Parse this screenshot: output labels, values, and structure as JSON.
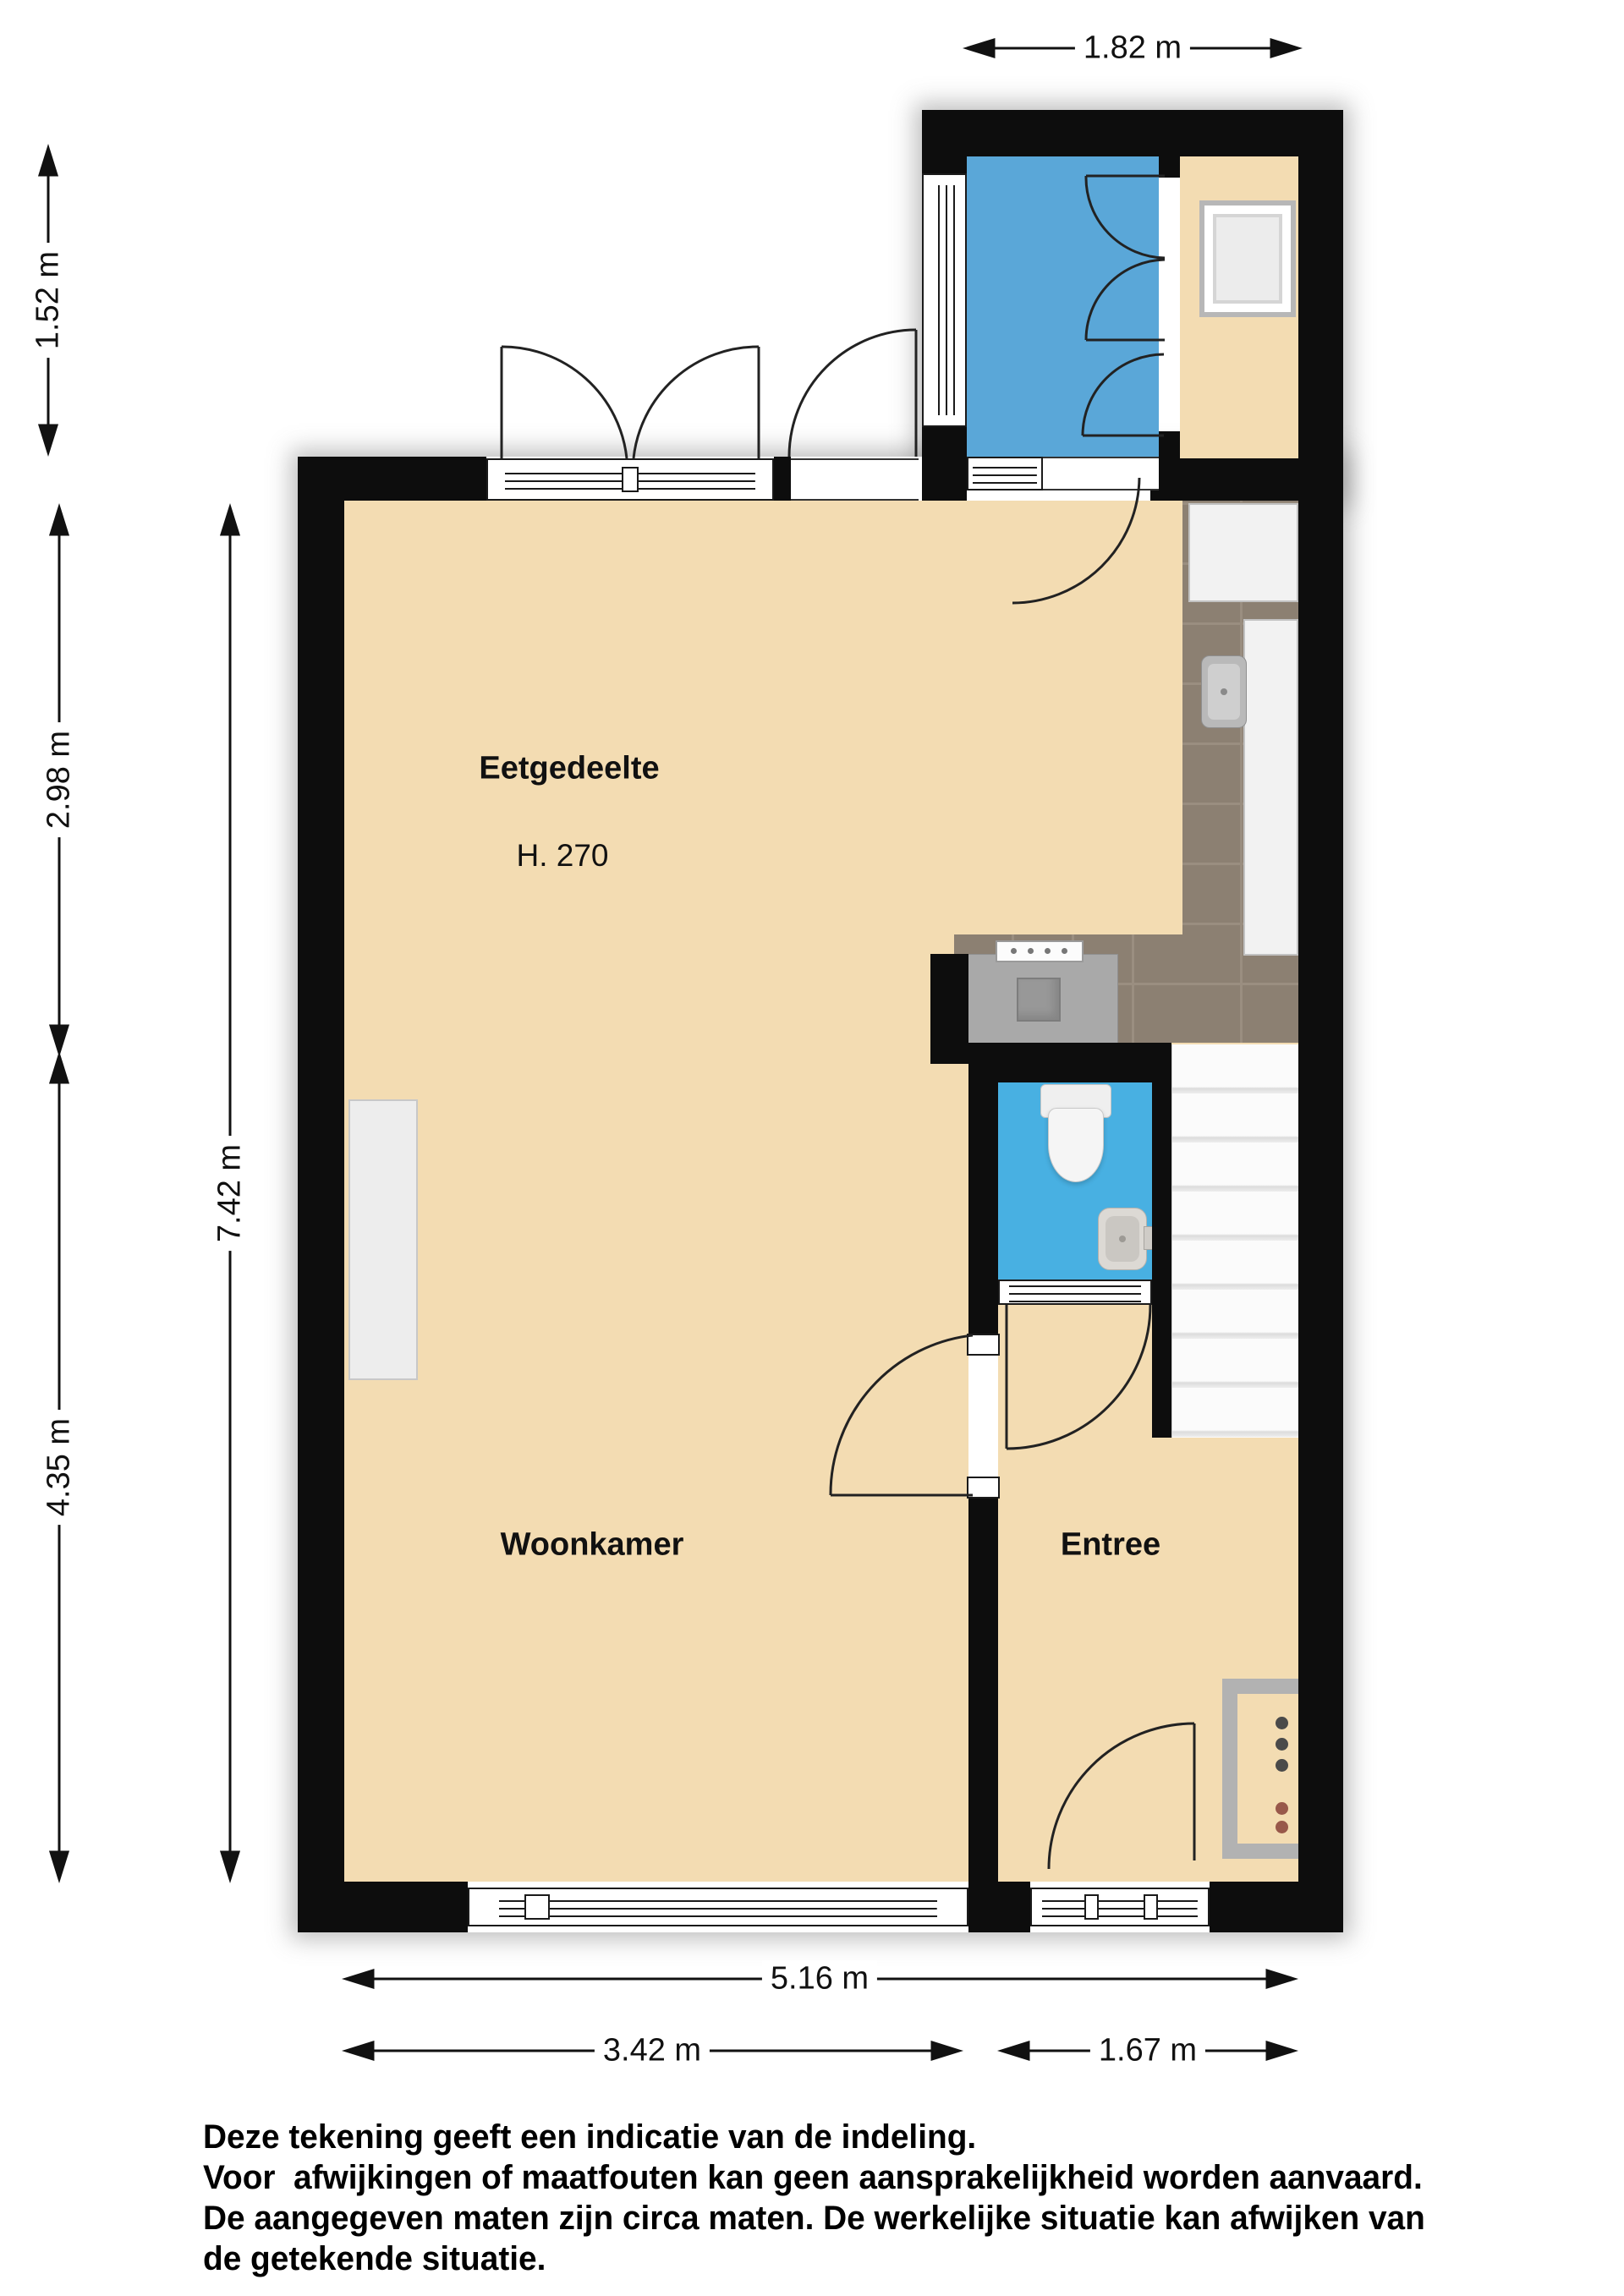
{
  "plan": {
    "type": "floorplan-ground-floor",
    "rooms": {
      "eetgedeelte": {
        "label": "Eetgedeelte",
        "ceiling_height": "H. 270"
      },
      "woonkamer": {
        "label": "Woonkamer"
      },
      "entree": {
        "label": "Entree"
      }
    },
    "dimensions": {
      "annex_width": "1.82 m",
      "annex_depth": "1.52 m",
      "eetgedeelte_depth": "2.98 m",
      "woonkamer_depth": "4.35 m",
      "total_depth": "7.42 m",
      "total_width": "5.16 m",
      "woonkamer_width": "3.42 m",
      "entree_width": "1.67 m"
    },
    "disclaimer": {
      "line1": "Deze tekening geeft een indicatie van de indeling.",
      "line2": "Voor  afwijkingen of maatfouten kan geen aansprakelijkheid worden aanvaard.",
      "line3": "De aangegeven maten zijn circa maten. De werkelijke situatie kan afwijken van",
      "line4": "de getekende situatie."
    },
    "colors": {
      "wall": "#0d0d0d",
      "floor_beige": "#f3dcb2",
      "bathroom_blue": "#5aa7d8",
      "toilet_blue": "#48b0e2",
      "kitchen_tile": "#8c8072",
      "counter_gray": "#a9a9a9",
      "fixture_white": "#f2f2f2"
    }
  }
}
